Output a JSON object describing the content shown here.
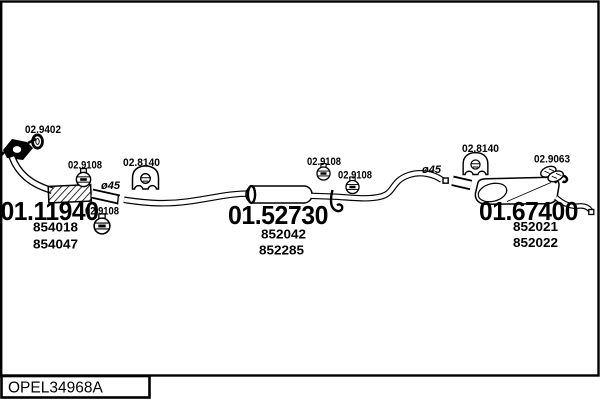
{
  "window": {
    "footer_code": "OPEL34968A"
  },
  "diagram": {
    "type": "exhaust-system-parts-diagram",
    "parts": {
      "front_pipe": {
        "code": "01.11940",
        "oe_numbers": [
          "854018",
          "854047"
        ]
      },
      "centre_silencer": {
        "code": "01.52730",
        "oe_numbers": [
          "852042",
          "852285"
        ]
      },
      "rear_silencer": {
        "code": "01.67400",
        "oe_numbers": [
          "852021",
          "852022"
        ]
      }
    },
    "fittings": {
      "gasket_code": "02.9402",
      "clamp_code": "02.9108",
      "rubber_mount_code": "02.8140",
      "hanger_code": "02.9063"
    },
    "annotations": {
      "pipe_diameter": "ø45"
    },
    "icons": {
      "gasket-icon": "double-ring",
      "clamp-icon": "circle-clamp-with-bolt",
      "rubber-mount-icon": "mount-block-with-wheel-cutouts",
      "hanger-icon": "rubber-strap-hanger",
      "flange-icon": "inlet-flange"
    },
    "colors": {
      "ink": "#000000",
      "paper": "#ffffff"
    }
  }
}
